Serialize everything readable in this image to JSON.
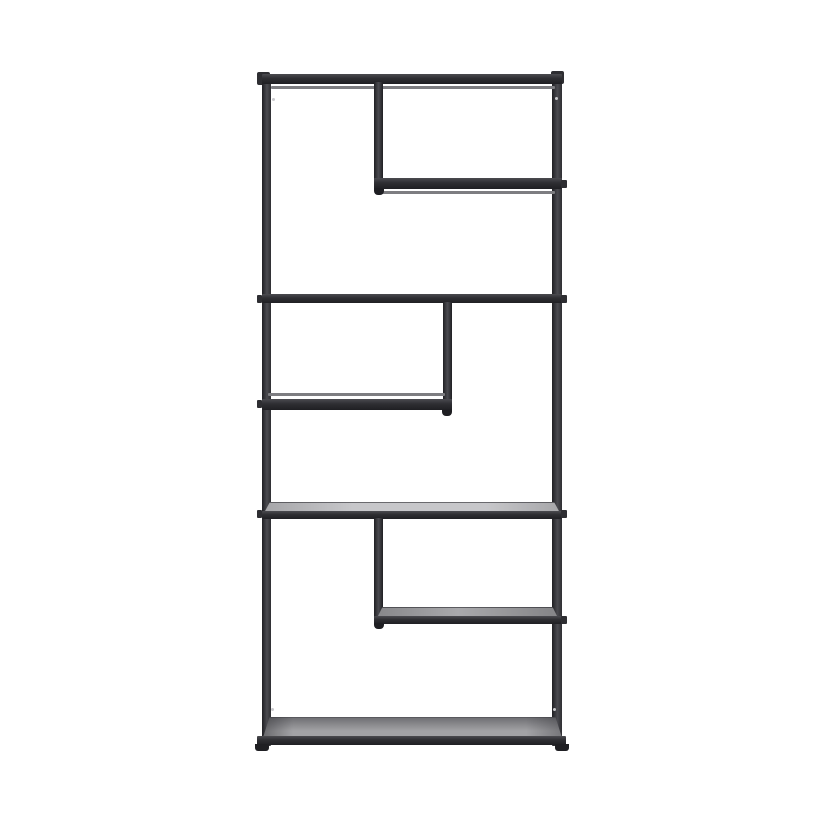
{
  "subject": "Product photo: tall black metal etagere bookcase with six staggered open shelves on a white background",
  "background": "#ffffff",
  "colors": {
    "background": "#ffffff",
    "frame-dark": "#1f1f23",
    "frame": "#2e2e32",
    "frame-light": "#4b4b50",
    "rail": "#7d7d81",
    "surface-light-1": "#c7c7ca",
    "surface-light-2": "#a6a6a9",
    "surface-mid-1": "#a9a9ac",
    "surface-mid-2": "#87878a",
    "surface-bottom-1": "#a3a3a6",
    "surface-bottom-2": "#707074",
    "screw": "#c9c9cc"
  },
  "structure": {
    "material": "powder-coated metal frame with grey board shelf panels",
    "posts": [
      "left-post",
      "right-post"
    ],
    "tiers": [
      {
        "level": 1,
        "element": "top-bar",
        "span": "full-width"
      },
      {
        "level": 2,
        "element": "shelf-1",
        "span": "right-partial",
        "supported_by": "upper-divider"
      },
      {
        "level": 3,
        "element": "shelf-2",
        "span": "full-width"
      },
      {
        "level": 4,
        "element": "shelf-3",
        "span": "left-partial",
        "supported_by": "middle-divider"
      },
      {
        "level": 5,
        "element": "shelf-4",
        "span": "full-width"
      },
      {
        "level": 6,
        "element": "shelf-5",
        "span": "right-partial",
        "supported_by": "lower-divider"
      },
      {
        "level": 7,
        "element": "bottom-shelf",
        "span": "full-width"
      }
    ],
    "feet_count": 2
  }
}
